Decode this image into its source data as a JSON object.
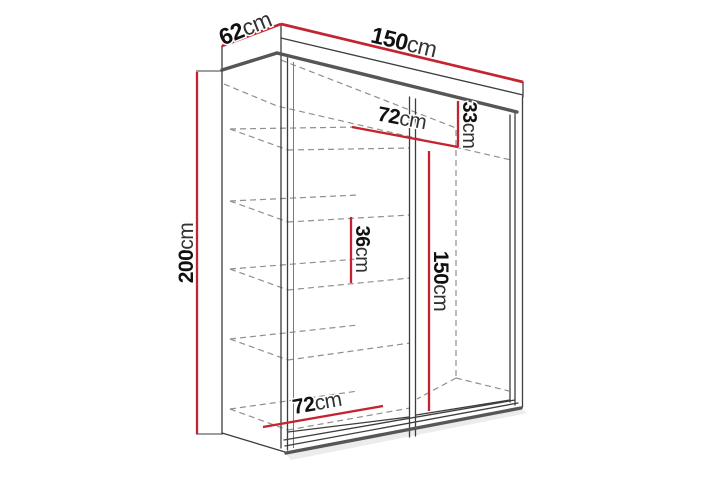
{
  "page": {
    "background_color": "#ffffff"
  },
  "diagram": {
    "kind": "wardrobe-dimension-line-drawing",
    "colors": {
      "dimension_line": "#c42430",
      "outline": "#3d3d3d",
      "outline_thick": "#565656",
      "hidden_line": "#8f8f8f",
      "label_number": "#111111",
      "label_unit": "#333333"
    },
    "dimensions": {
      "depth": {
        "value": "62",
        "unit": "cm"
      },
      "width": {
        "value": "150",
        "unit": "cm"
      },
      "height": {
        "value": "200",
        "unit": "cm"
      },
      "upper_shelf_height": {
        "value": "33",
        "unit": "cm"
      },
      "upper_shelf_width": {
        "value": "72",
        "unit": "cm"
      },
      "shelf_spacing": {
        "value": "36",
        "unit": "cm"
      },
      "hanging_space_height": {
        "value": "150",
        "unit": "cm"
      },
      "lower_shelf_width": {
        "value": "72",
        "unit": "cm"
      }
    }
  }
}
